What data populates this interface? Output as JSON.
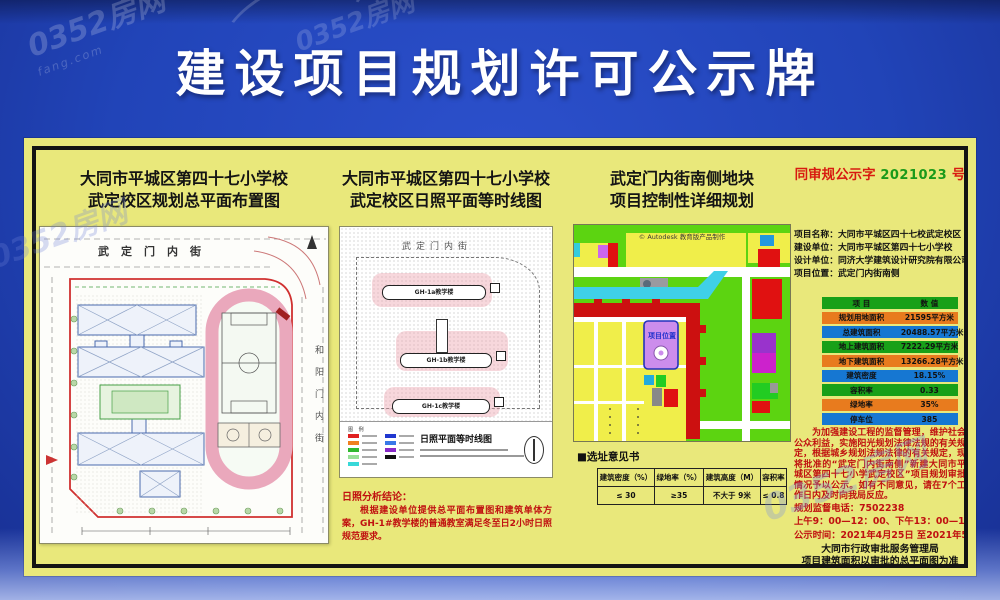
{
  "banner": {
    "title": "建设项目规划许可公示牌"
  },
  "watermark": {
    "brand": "0352房网",
    "domain": "fang.com"
  },
  "left_panel": {
    "title_line1": "大同市平城区第四十七小学校",
    "title_line2": "武定校区规划总平面布置图",
    "street_top": "武定门内街",
    "street_right": "和阳门内街"
  },
  "mid_panel": {
    "title_line1": "大同市平城区第四十七小学校",
    "title_line2": "武定校区日照平面等时线图",
    "street_top": "武定门内街",
    "buildings": [
      "GH-1a教学楼",
      "GH-1b教学楼",
      "GH-1c教学楼"
    ],
    "legend_label": "图 例",
    "legend_title": "日照平面等时线图",
    "conclusion_title": "日照分析结论：",
    "conclusion_body": "根据建设单位提供总平面布置图和建筑单体方案，GH-1#教学楼的普通教室满足冬至日2小时日照规范要求。"
  },
  "map_panel": {
    "title_line1": "武定门内街南侧地块",
    "title_line2": "项目控制性详细规划",
    "autodesk_note": "© Autodesk 教育版产品制作",
    "site_label": "项目位置",
    "section_title": "■选址意见书",
    "table": {
      "headers": [
        "建筑密度（%）",
        "绿地率（%）",
        "建筑高度（M）",
        "容积率"
      ],
      "values": [
        "≤ 30",
        "≥35",
        "不大于 9米",
        "≤ 0.8"
      ]
    }
  },
  "right_panel": {
    "stamp": {
      "prefix": "同审规公示字",
      "number": "2021023",
      "suffix": "号"
    },
    "info": [
      {
        "label": "项目名称：",
        "value": "大同市平城区四十七校武定校区"
      },
      {
        "label": "建设单位：",
        "value": "大同市平城区第四十七小学校"
      },
      {
        "label": "设计单位：",
        "value": "同济大学建筑设计研究院有限公司"
      },
      {
        "label": "项目位置：",
        "value": "武定门内街南侧"
      }
    ],
    "table": {
      "col_item": "项  目",
      "col_value": "数  值",
      "rows": [
        {
          "label": "规划用地面积",
          "value": "21595平方米"
        },
        {
          "label": "总建筑面积",
          "value": "20488.57平方米"
        },
        {
          "label": "地上建筑面积",
          "value": "7222.29平方米"
        },
        {
          "label": "地下建筑面积",
          "value": "13266.28平方米"
        },
        {
          "label": "建筑密度",
          "value": "18.15%"
        },
        {
          "label": "容积率",
          "value": "0.33"
        },
        {
          "label": "绿地率",
          "value": "35%"
        },
        {
          "label": "停车位",
          "value": "385"
        }
      ]
    },
    "notice": "为加强建设工程的监督管理，维护社会公众利益，实施阳光规划法律法规的有关规定，根据城乡规划法规法律的有关规定，现将批准的“武定门内街南侧”新建大同市平城区第四十七小学武定校区”项目规划审批情况予以公示。如有不同意见，请在7个工作日内及时向我局反应。",
    "phone_line": "规划监督电话：7502238",
    "hours_line": "上午9：00—12：00、下午13：00—17：00",
    "period_line": "公示时间：2021年4月25日 至2021年5月6日",
    "agency": "大同市行政审批服务管理局",
    "footnote": "项目建筑面积以审批的总平面图为准"
  },
  "colors": {
    "background_blue": "#2144b8",
    "panel_yellow": "#e9e87b",
    "stamp_red": "#d81b10",
    "stamp_green": "#1a9a1a",
    "row_orange": "#e87b1e",
    "row_blue": "#1677d2",
    "row_green": "#18a018",
    "notice_red": "#c01010"
  }
}
